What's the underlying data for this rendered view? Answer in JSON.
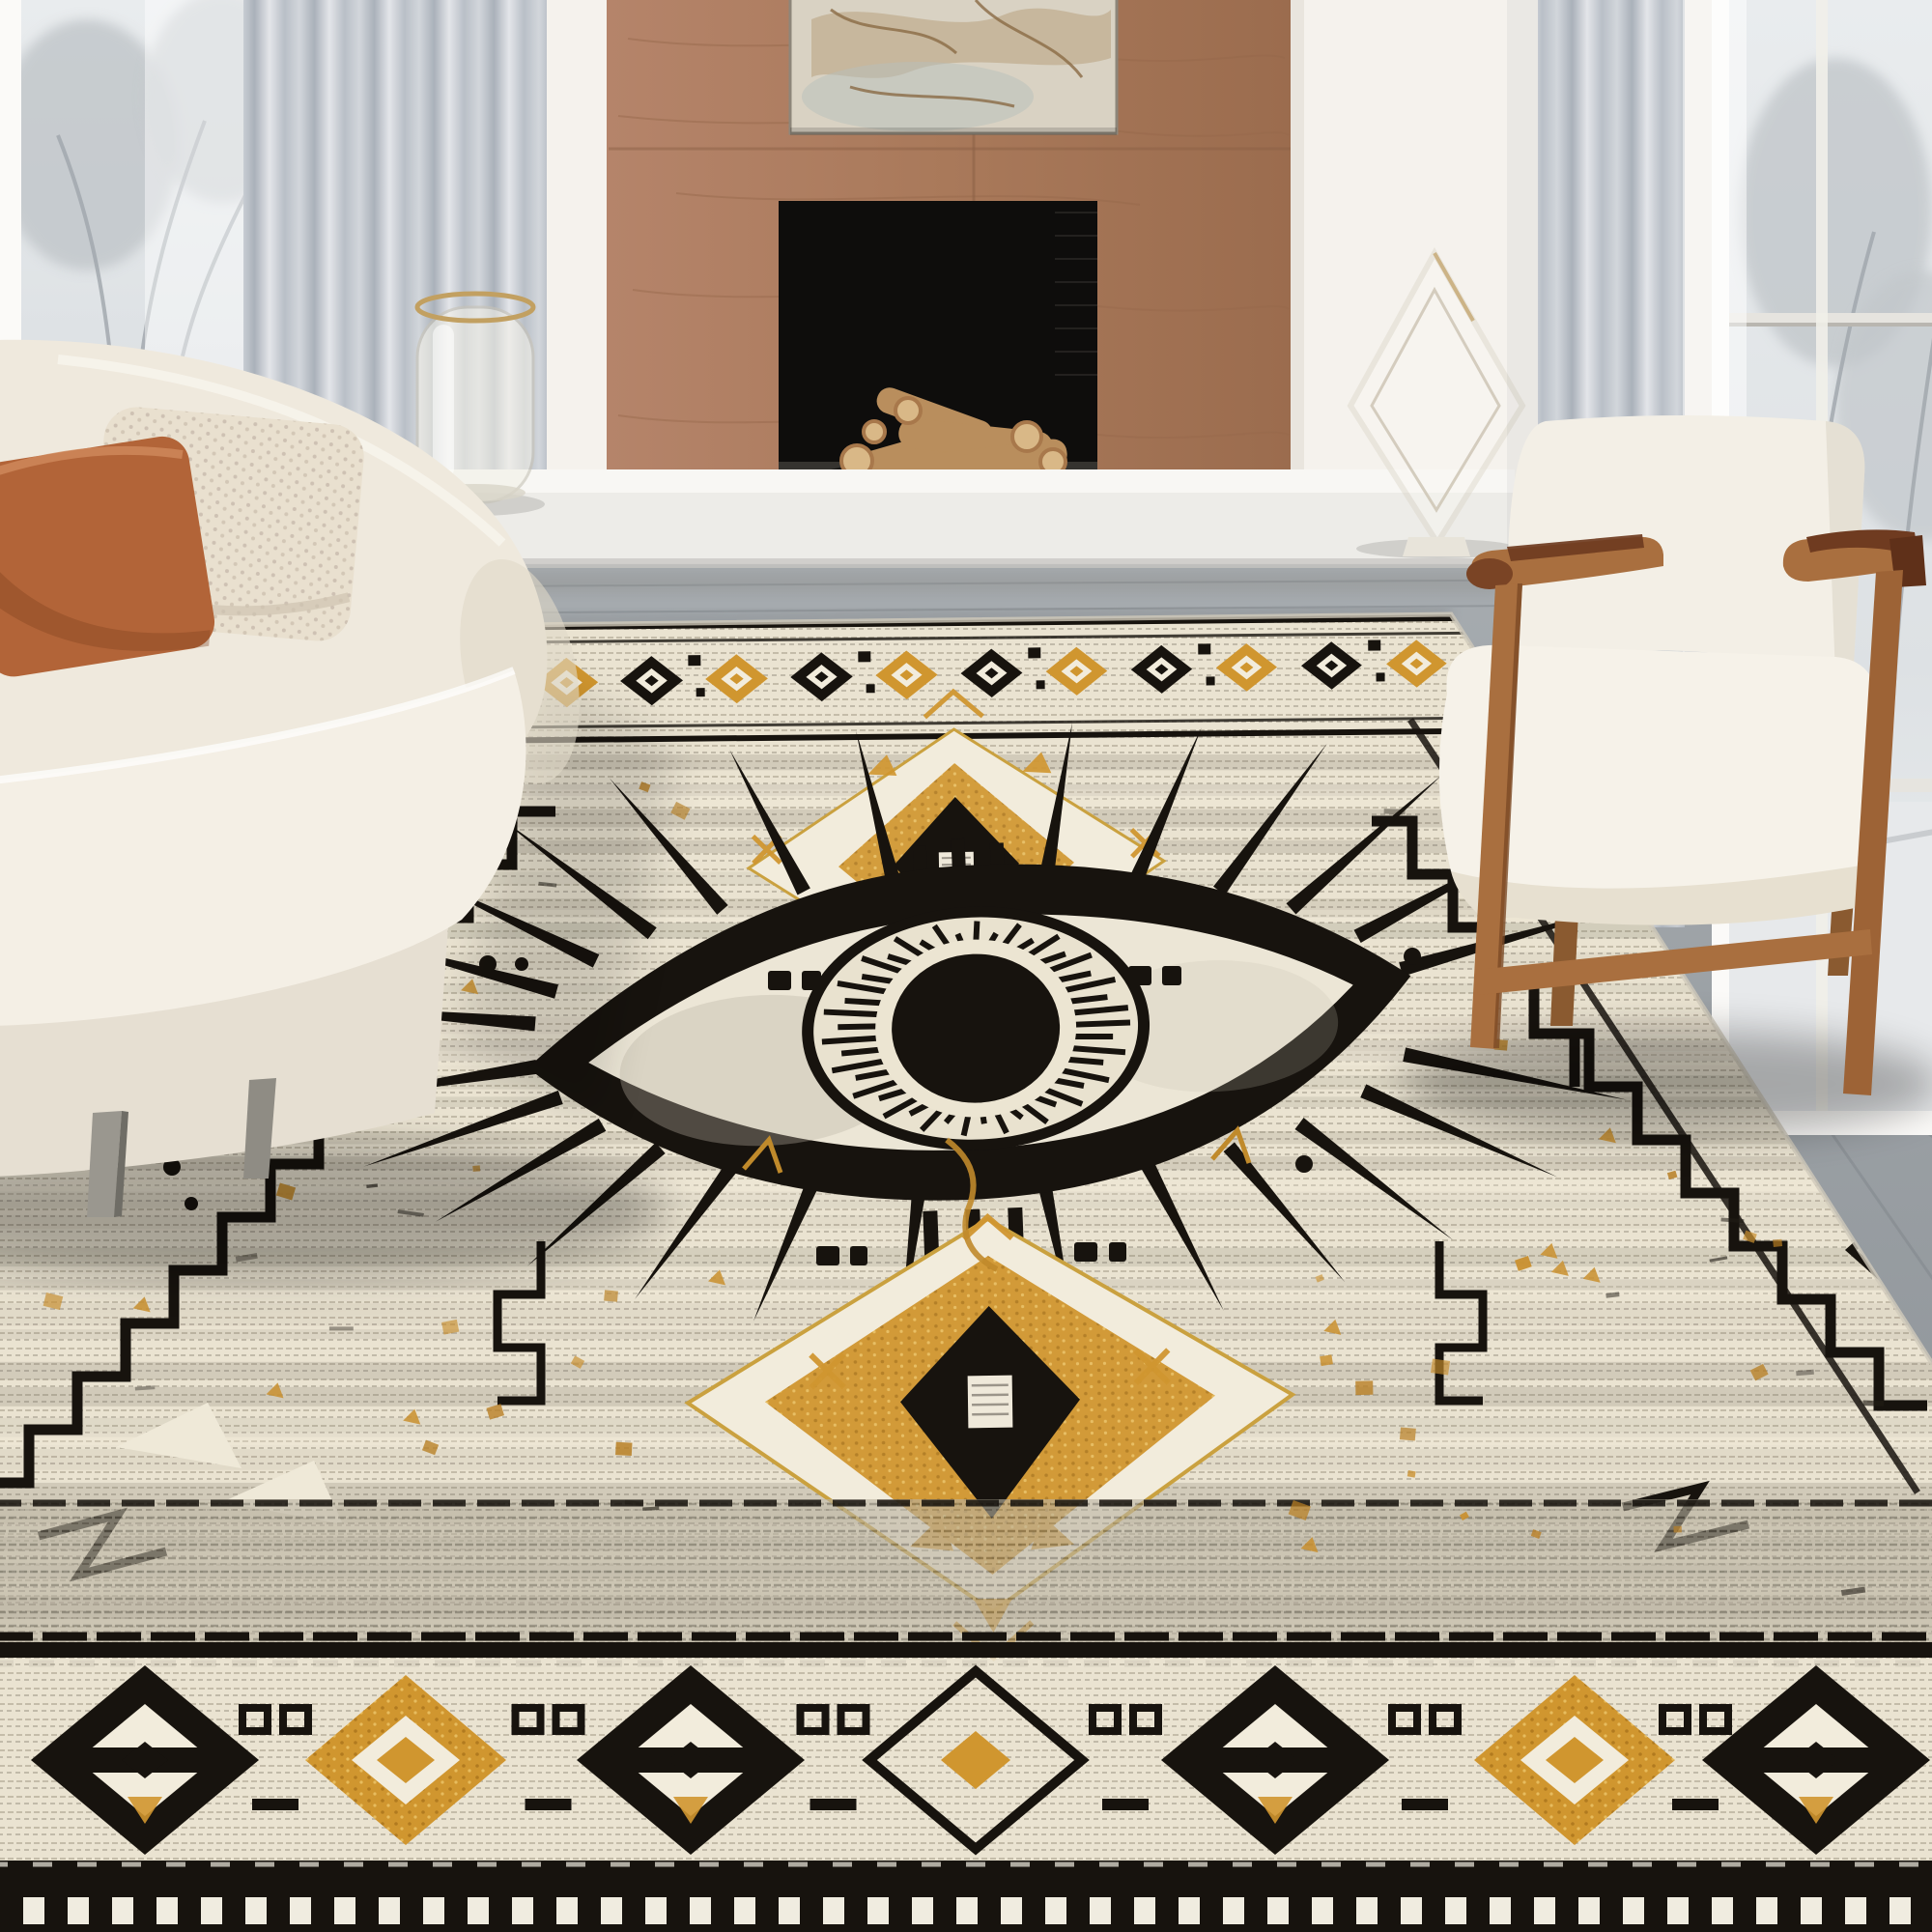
{
  "scene": {
    "title": "Bohemian evil eye area rug styled in a modern living room",
    "kind": "interior product photograph",
    "no_visible_text": true
  },
  "objects": {
    "rug": {
      "label": "Boho Aztec evil eye area rug in cream, grey, black and mustard gold"
    },
    "eye": {
      "label": "Large black evil eye motif with radiating lashes"
    },
    "medallion_top": {
      "label": "Gold diamond medallion above the eye"
    },
    "medallion_bottom": {
      "label": "Gold diamond medallion below the eye"
    },
    "border_bottom": {
      "label": "Bottom border of alternating black and gold diamonds"
    },
    "sofa": {
      "label": "Cream upholstered sofa with terracotta and boucle pillows"
    },
    "armchair": {
      "label": "White cushion armchair with warm wood frame"
    },
    "fireplace": {
      "label": "Modern fireplace with wood panel surround and stacked firewood"
    },
    "artwork": {
      "label": "Abstract marble artwork above the fireplace"
    },
    "bench": {
      "label": "White floating hearth bench"
    },
    "vase": {
      "label": "Glass hurricane vase with gold rim"
    },
    "sculpture": {
      "label": "Clear glass diamond sculpture"
    },
    "window_left": {
      "label": "Tall window with grey curtain and winter trees"
    },
    "window_right": {
      "label": "Tall window with grey curtain and winter trees"
    },
    "floor": {
      "label": "Grey wood plank floor"
    }
  },
  "palette": {
    "wall": "#efebe4",
    "wall-bright": "#f5f2ed",
    "wood": "#a9795a",
    "wood-dark": "#8f6347",
    "floor": "#9aa0a5",
    "floor-dark": "#83888d",
    "curtain-a": "#d2d6db",
    "curtain-b": "#aab1ba",
    "glass": "#dde1e4",
    "tree": "#c2c7cb",
    "snow": "#e7e9eb",
    "rug-cream": "#eae3d1",
    "rug-cream2": "#f2ecdc",
    "rug-black": "#17130e",
    "rug-gray": "#6c6759",
    "rug-gold": "#d0962f",
    "rug-gold-dark": "#a9731c",
    "sofa": "#efe9dd",
    "sofa-dark": "#e2dac9",
    "terracotta": "#b26438",
    "boucle": "#e9e0cf",
    "chair-wood": "#a96f3f",
    "chair-wood-dark": "#7a4425",
    "leather": "#6f3b20",
    "bench": "#edece8",
    "bench-top": "#f8f7f4",
    "art": "#d9d2c3",
    "log": "#b98e5d",
    "log-end": "#d9b887",
    "firebox": "#0e0d0c"
  }
}
